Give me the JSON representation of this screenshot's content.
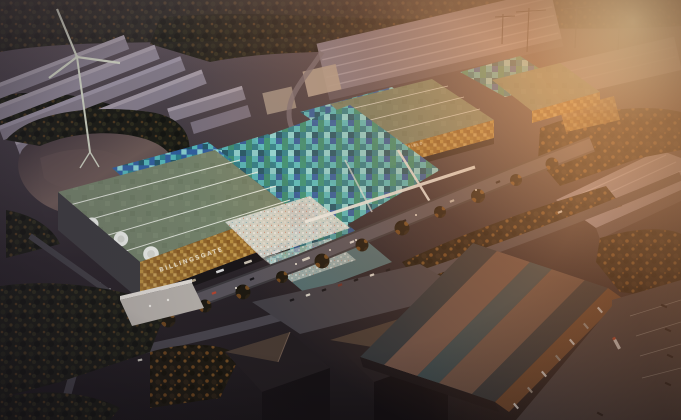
{
  "scene": {
    "description": "Aerial dusk rendering of a market logistics campus with wind turbine, lake and warehouses",
    "buildings": [
      {
        "id": "billingsgate-hall",
        "label": "BILLINGSGATE"
      },
      {
        "id": "smithfield-hall",
        "label": "SMITHFIELD"
      }
    ],
    "palette": {
      "base_top": "#5b5058",
      "base_mid": "#463e45",
      "base_low": "#2a2429",
      "base_bottom": "#1b171a",
      "distant_roof": "#837b88",
      "distant_roof_lit": "#a39aa5",
      "distant_wall": "#5e5660",
      "cream_shed": "#b3a393",
      "tree_dark": "#191a13",
      "tree_autumn": "#8a5526",
      "water": "#362d34",
      "water_sheen": "#6d5a55",
      "turbine": "#cfd4c2",
      "green_roof": "#74836a",
      "roof_line": "#eef2e8",
      "gold_1": "#b98f3f",
      "gold_2": "#93672a",
      "gold_3": "#c9a258",
      "mosaic_1": "#2a8693",
      "mosaic_2": "#54c2c6",
      "mosaic_3": "#1d5b6e",
      "mosaic_4": "#2e62a8",
      "mosaic_5": "#8fdfdf",
      "mosaic_6": "#35967a",
      "road": "#57535a",
      "road_dark": "#46434a",
      "road_light": "#6c676d",
      "plaza": "#d8dcd4",
      "bigbox_dark": "#2c3237",
      "bigbox_teal": "#32444a",
      "bigbox_stripe": "#6d5044",
      "bigbox_wall": "#62402a",
      "dark_build": "#221d20",
      "dark_build_lit": "#463931",
      "lot": "#413e44",
      "truck_white": "#d9d9d9",
      "truck_red": "#b5452f",
      "car_dark": "#17161a",
      "wall_dark": "#3c3b3e",
      "canal": "#7b7279"
    }
  }
}
